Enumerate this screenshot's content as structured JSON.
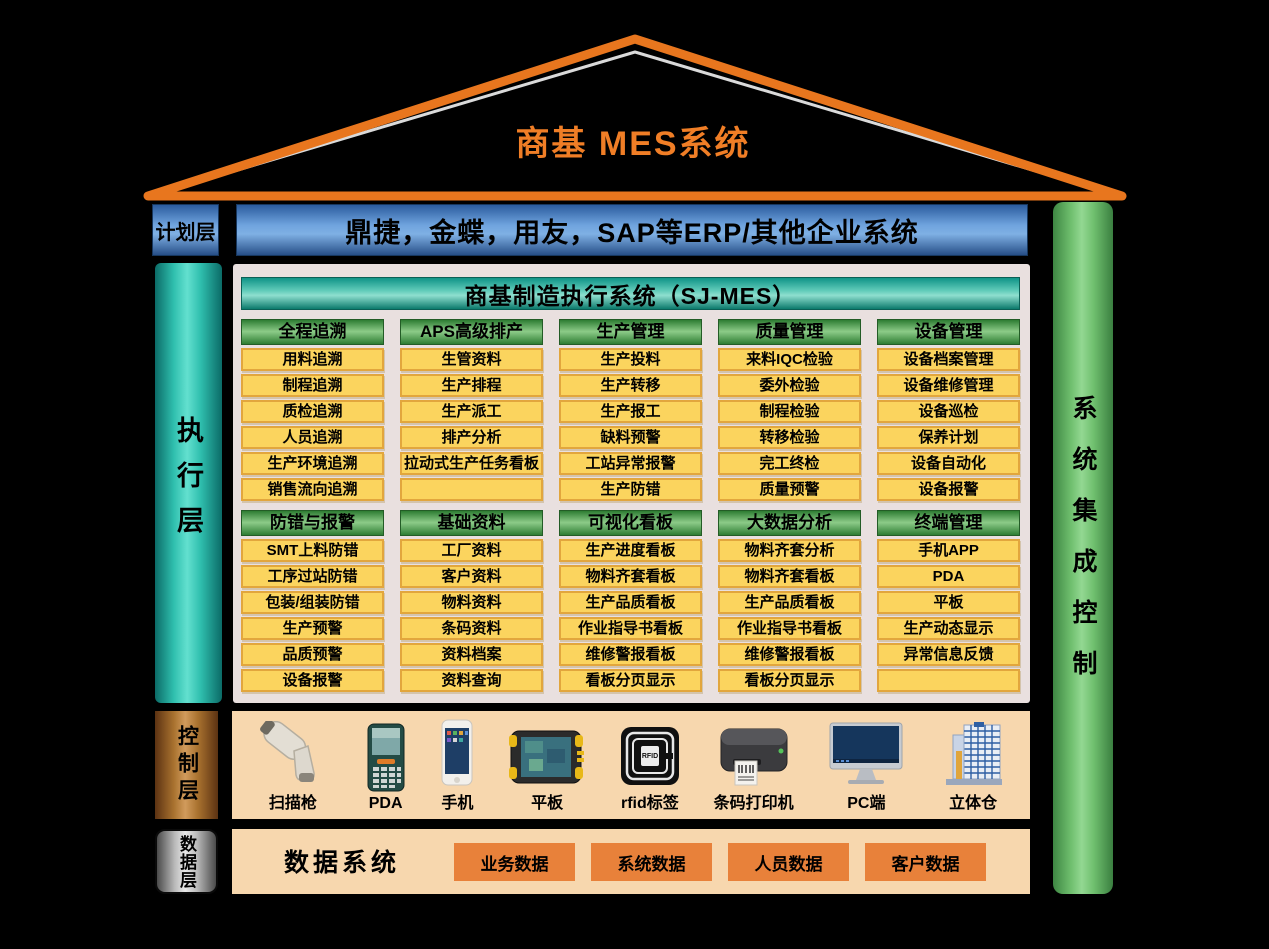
{
  "colors": {
    "accent_orange": "#F07E26",
    "roof_stroke": "#E8761E",
    "blue_bar": "#4472C4",
    "teal_pillar": "#2FBFAE",
    "green_pillar": "#6FBF6E",
    "module_header_green": "#2E7D33",
    "item_yellow": "#FBD45E",
    "item_border": "#E2A63D",
    "panel_gray": "#E9E0DF",
    "peach_panel": "#F7D7AE",
    "data_box_orange": "#E8813A",
    "copper_bar": "#A9722F"
  },
  "roof": {
    "title": "商基  MES系统"
  },
  "plan_layer": {
    "label": "计划层",
    "erp_text": "鼎捷，金蝶，用友，SAP等ERP/其他企业系统"
  },
  "exec_layer": {
    "label": "执行层"
  },
  "integration_bar": {
    "label": "系统集成控制"
  },
  "mes": {
    "panel_title": "商基制造执行系统（SJ-MES）",
    "rows": [
      [
        {
          "header": "全程追溯",
          "items": [
            "用料追溯",
            "制程追溯",
            "质检追溯",
            "人员追溯",
            "生产环境追溯",
            "销售流向追溯"
          ]
        },
        {
          "header": "APS高级排产",
          "items": [
            "生管资料",
            "生产排程",
            "生产派工",
            "排产分析",
            "拉动式生产任务看板",
            ""
          ]
        },
        {
          "header": "生产管理",
          "items": [
            "生产投料",
            "生产转移",
            "生产报工",
            "缺料预警",
            "工站异常报警",
            "生产防错"
          ]
        },
        {
          "header": "质量管理",
          "items": [
            "来料IQC检验",
            "委外检验",
            "制程检验",
            "转移检验",
            "完工终检",
            "质量预警"
          ]
        },
        {
          "header": "设备管理",
          "items": [
            "设备档案管理",
            "设备维修管理",
            "设备巡检",
            "保养计划",
            "设备自动化",
            "设备报警"
          ]
        }
      ],
      [
        {
          "header": "防错与报警",
          "items": [
            "SMT上料防错",
            "工序过站防错",
            "包装/组装防错",
            "生产预警",
            "品质预警",
            "设备报警"
          ]
        },
        {
          "header": "基础资料",
          "items": [
            "工厂资料",
            "客户资料",
            "物料资料",
            "条码资料",
            "资料档案",
            "资料查询"
          ]
        },
        {
          "header": "可视化看板",
          "items": [
            "生产进度看板",
            "物料齐套看板",
            "生产品质看板",
            "作业指导书看板",
            "维修警报看板",
            "看板分页显示"
          ]
        },
        {
          "header": "大数据分析",
          "items": [
            "物料齐套分析",
            "物料齐套看板",
            "生产品质看板",
            "作业指导书看板",
            "维修警报看板",
            "看板分页显示"
          ]
        },
        {
          "header": "终端管理",
          "items": [
            "手机APP",
            "PDA",
            "平板",
            "生产动态显示",
            "异常信息反馈",
            ""
          ]
        }
      ]
    ]
  },
  "control_layer": {
    "label": "控制层",
    "devices": [
      {
        "name": "扫描枪",
        "icon": "scanner-icon"
      },
      {
        "name": "PDA",
        "icon": "pda-icon"
      },
      {
        "name": "手机",
        "icon": "phone-icon"
      },
      {
        "name": "平板",
        "icon": "tablet-icon"
      },
      {
        "name": "rfid标签",
        "icon": "rfid-icon"
      },
      {
        "name": "条码打印机",
        "icon": "barcode-printer-icon"
      },
      {
        "name": "PC端",
        "icon": "pc-icon"
      },
      {
        "name": "立体仓",
        "icon": "warehouse-icon"
      }
    ]
  },
  "data_layer": {
    "label": "数据层",
    "title": "数据系统",
    "boxes": [
      "业务数据",
      "系统数据",
      "人员数据",
      "客户数据"
    ]
  }
}
